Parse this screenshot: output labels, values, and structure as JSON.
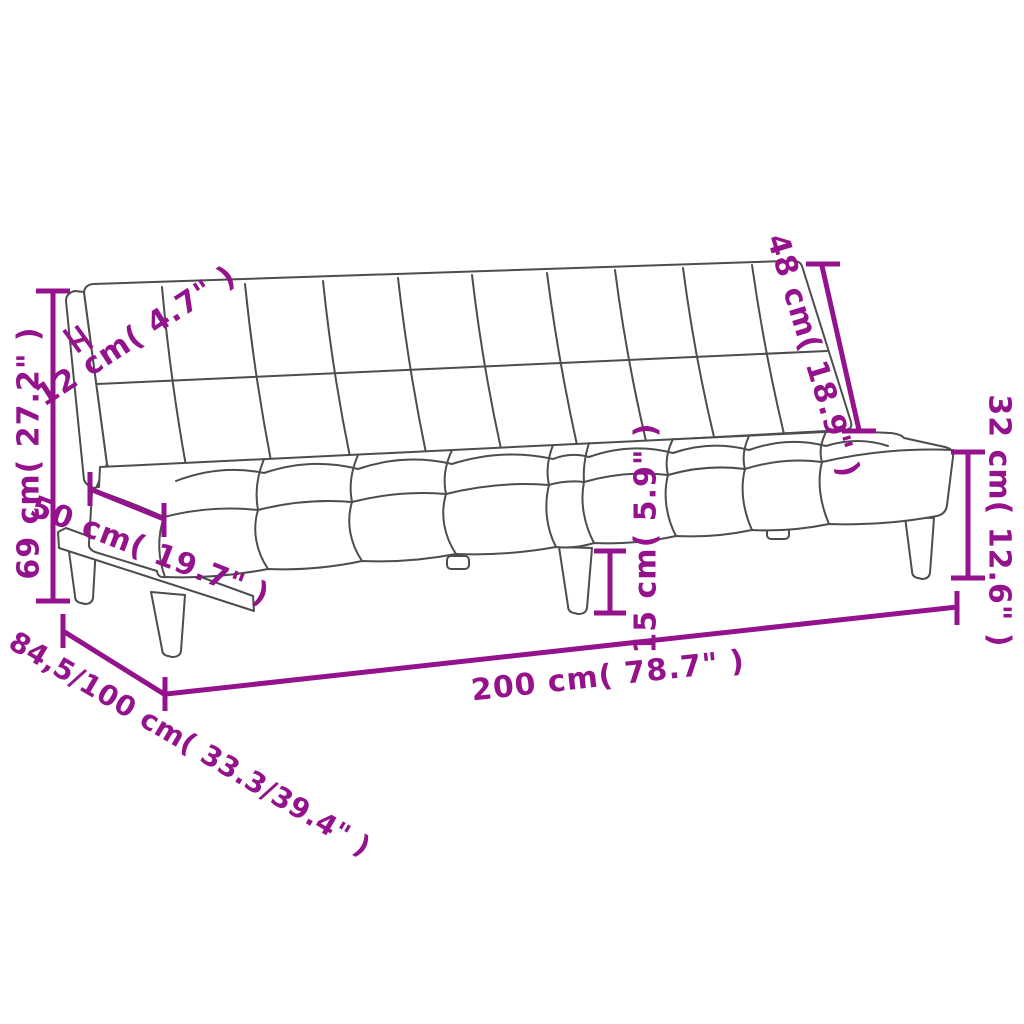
{
  "diagram": {
    "product": "sofa-bed",
    "accent_color": "#94128C",
    "line_color": "#4D4D4F",
    "background": "#FFFFFF",
    "dimensions": [
      {
        "id": "overall-height",
        "label": "69 cm( 27.2\" )"
      },
      {
        "id": "backrest-thickness",
        "label": "12 cm( 4.7\" )"
      },
      {
        "id": "seat-depth",
        "label": "50 cm( 19.7\" )"
      },
      {
        "id": "backrest-height",
        "label": "48 cm( 18.9\" )"
      },
      {
        "id": "seat-height",
        "label": "32 cm( 12.6\" )"
      },
      {
        "id": "leg-height",
        "label": "15 cm( 5.9\" )"
      },
      {
        "id": "overall-width",
        "label": "200 cm( 78.7\" )"
      },
      {
        "id": "overall-depth",
        "label": "84,5/100 cm( 33.3/39.4\" )"
      }
    ]
  }
}
